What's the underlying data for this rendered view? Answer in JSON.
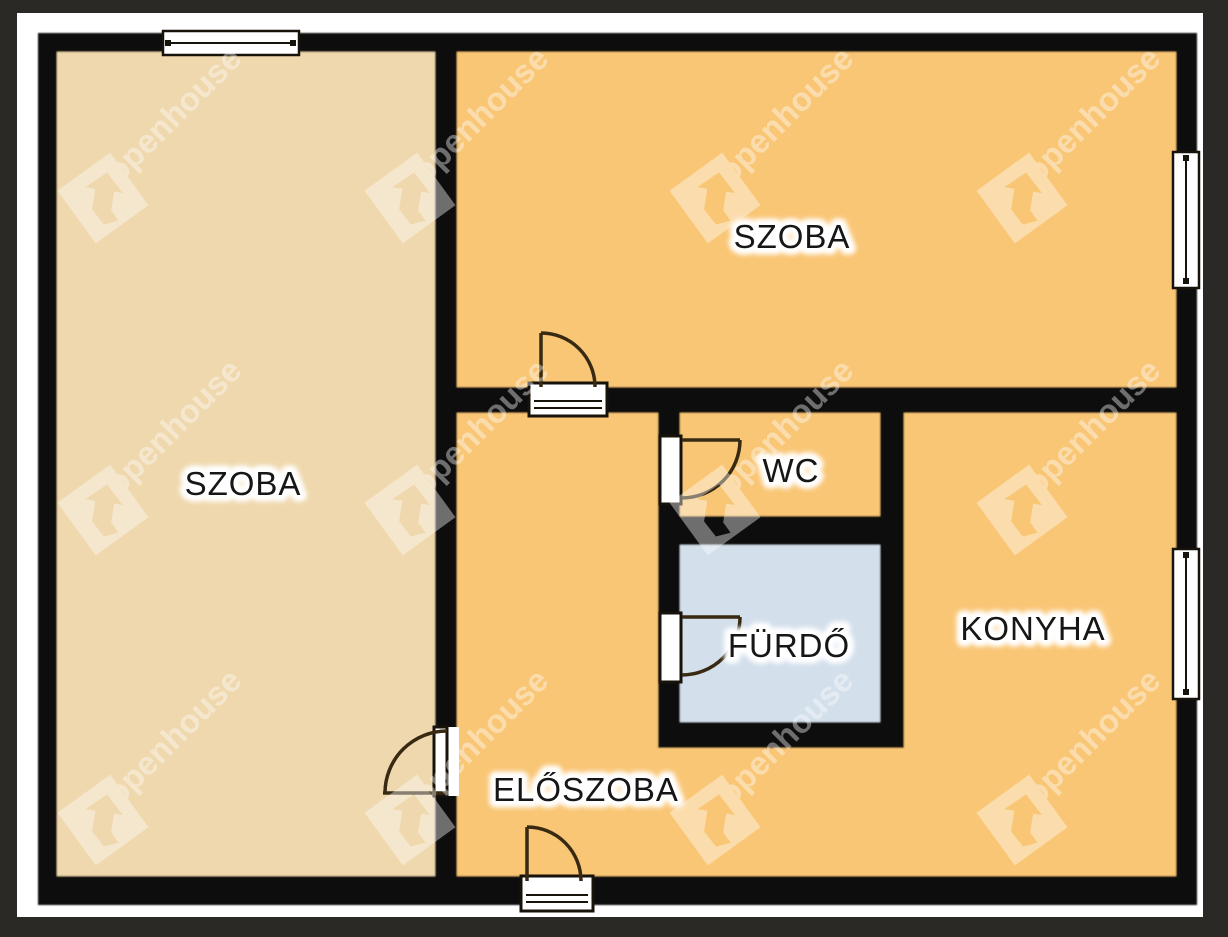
{
  "plan": {
    "rooms": {
      "szoba_left": {
        "label": "SZOBA"
      },
      "szoba_top": {
        "label": "SZOBA"
      },
      "wc": {
        "label": "WC"
      },
      "furdo": {
        "label": "FÜRDŐ"
      },
      "konyha": {
        "label": "KONYHA"
      },
      "eloszoba": {
        "label": "ELŐSZOBA"
      }
    }
  },
  "watermark": {
    "text": "openhouse"
  },
  "colors": {
    "background": "#2a2926",
    "page": "#ffffff",
    "wall": "#0d0c0a",
    "room_beige": "#efd8ad",
    "room_orange": "#f9c675",
    "room_blue": "#d3dfeb",
    "watermark": "#ffffff"
  }
}
